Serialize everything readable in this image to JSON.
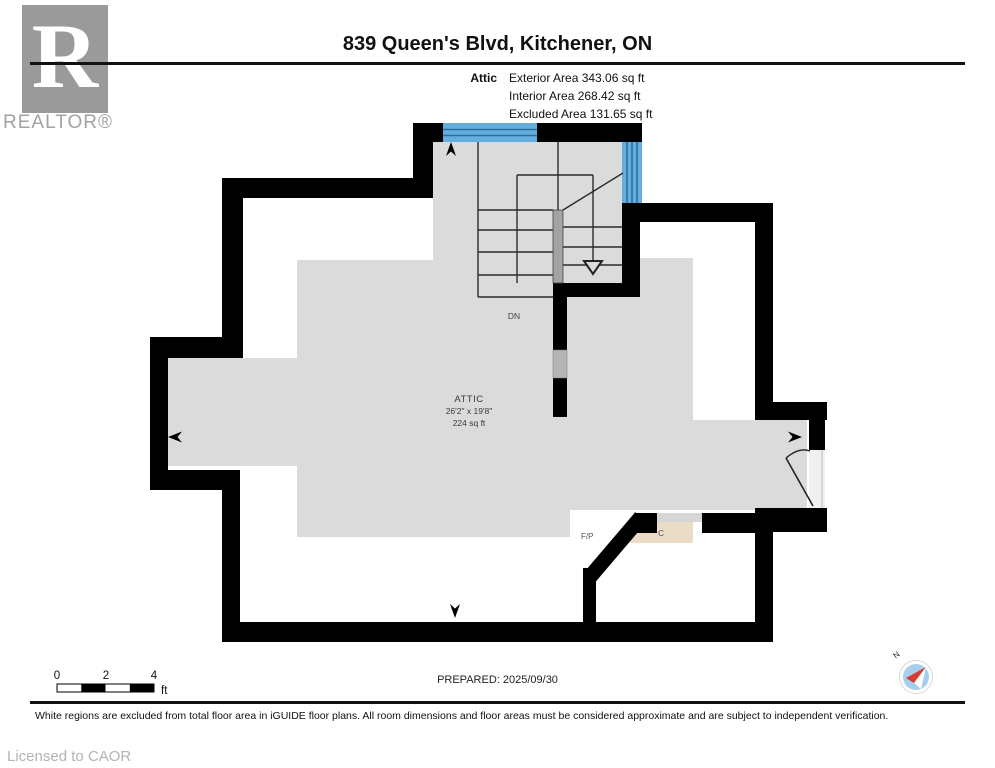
{
  "header": {
    "title": "839 Queen's Blvd, Kitchener, ON",
    "floor_label": "Attic",
    "area_lines": [
      "Exterior Area 343.06 sq ft",
      "Interior Area 268.42 sq ft",
      "Excluded Area 131.65 sq ft"
    ]
  },
  "branding": {
    "logo_letter": "R",
    "logo_name": "REALTOR®"
  },
  "plan": {
    "room": {
      "name": "ATTIC",
      "dimensions": "26'2\" x 19'8\"",
      "area": "224 sq ft"
    },
    "labels": {
      "stairs": "DN",
      "fireplace": "F/P",
      "closet": "C"
    },
    "colors": {
      "wall": "#000000",
      "floor": "#dbdbdb",
      "window": "#64aedd",
      "closet_floor": "#ebddc5",
      "excluded": "#ffffff",
      "stair_divider": "#a3a3a3"
    }
  },
  "scale_bar": {
    "tick0": "0",
    "tick2": "2",
    "tick4": "4",
    "unit": "ft"
  },
  "compass": {
    "north": "N"
  },
  "footer": {
    "prepared": "PREPARED: 2025/09/30",
    "disclaimer": "White regions are excluded from total floor area in iGUIDE floor plans. All room dimensions and floor areas must be considered approximate and are subject to independent verification.",
    "license": "Licensed to CAOR"
  }
}
